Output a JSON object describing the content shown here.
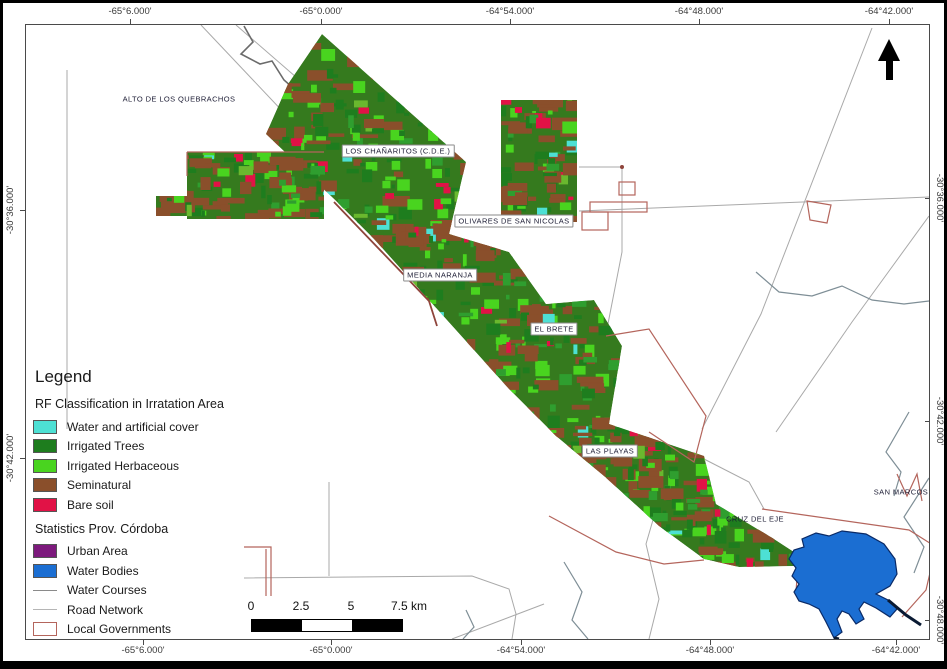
{
  "window": {
    "width": 947,
    "height": 669
  },
  "colors": {
    "frame": "#4a4a4a",
    "road": "#a9a9a9",
    "water_course": "#7e8e96",
    "dark_river": "#6b6b6b",
    "local_gov": "#b4655c",
    "local_gov_dark": "#8f453c",
    "water_body_fill": "#1b6ed2",
    "water_body_stroke": "#0a2a66",
    "raster_base": "#357a1e",
    "raster_palette": [
      {
        "color": "#8a4f2b",
        "w": 0.32
      },
      {
        "color": "#1e7d1e",
        "w": 0.26
      },
      {
        "color": "#49d41f",
        "w": 0.22
      },
      {
        "color": "#2f9e2f",
        "w": 0.1
      },
      {
        "color": "#6ab82e",
        "w": 0.04
      },
      {
        "color": "#e11246",
        "w": 0.04
      },
      {
        "color": "#4de0d4",
        "w": 0.02
      }
    ]
  },
  "map": {
    "axis": {
      "top": [
        {
          "label": "-65°6.000'",
          "x": 127
        },
        {
          "label": "-65°0.000'",
          "x": 318
        },
        {
          "label": "-64°54.000'",
          "x": 507
        },
        {
          "label": "-64°48.000'",
          "x": 696
        },
        {
          "label": "-64°42.000'",
          "x": 886
        }
      ],
      "bottom": [
        {
          "label": "-65°6.000'",
          "x": 140
        },
        {
          "label": "-65°0.000'",
          "x": 328
        },
        {
          "label": "-64°54.000'",
          "x": 518
        },
        {
          "label": "-64°48.000'",
          "x": 707
        },
        {
          "label": "-64°42.000'",
          "x": 893
        }
      ],
      "left": [
        {
          "label": "-30°36.000'",
          "y": 207
        },
        {
          "label": "-30°42.000'",
          "y": 455
        }
      ],
      "right": [
        {
          "label": "-30°36.000'",
          "y": 195
        },
        {
          "label": "-30°42.000'",
          "y": 418
        },
        {
          "label": "-30°48.000'",
          "y": 617
        }
      ]
    },
    "places": [
      {
        "name": "ALTO DE LOS QUEBRACHOS",
        "x": 176,
        "y": 96,
        "boxed": false
      },
      {
        "name": "LOS CHAÑARITOS (C.D.E.)",
        "x": 395,
        "y": 148,
        "boxed": true
      },
      {
        "name": "OLIVARES DE SAN NICOLAS",
        "x": 511,
        "y": 218,
        "boxed": true
      },
      {
        "name": "MEDIA NARANJA",
        "x": 437,
        "y": 272,
        "boxed": true
      },
      {
        "name": "EL BRETE",
        "x": 551,
        "y": 326,
        "boxed": true
      },
      {
        "name": "LAS PLAYAS",
        "x": 607,
        "y": 448,
        "boxed": true
      },
      {
        "name": "CRUZ DEL EJE",
        "x": 752,
        "y": 516,
        "boxed": false
      },
      {
        "name": "SAN MARCOS",
        "x": 898,
        "y": 489,
        "boxed": false
      }
    ],
    "scalebar": {
      "labels": [
        {
          "text": "0",
          "x": 248
        },
        {
          "text": "2.5",
          "x": 298
        },
        {
          "text": "5",
          "x": 348
        },
        {
          "text": "7.5 km",
          "x": 406
        }
      ],
      "bar": {
        "x": 248,
        "y": 616,
        "segment_width": 50,
        "height": 11,
        "segments": [
          "#000000",
          "#ffffff",
          "#000000"
        ]
      }
    },
    "north_arrow": "north-arrow"
  },
  "legend": {
    "title": "Legend",
    "sections": [
      {
        "heading": "RF Classification in Irratation Area",
        "items": [
          {
            "label": "Water and artificial cover",
            "swatch": "#4de0d4",
            "type": "fill"
          },
          {
            "label": "Irrigated Trees",
            "swatch": "#1e7d1e",
            "type": "fill"
          },
          {
            "label": "Irrigated Herbaceous",
            "swatch": "#49d41f",
            "type": "fill"
          },
          {
            "label": "Seminatural",
            "swatch": "#8a4f2b",
            "type": "fill"
          },
          {
            "label": "Bare soil",
            "swatch": "#e11246",
            "type": "fill"
          }
        ]
      },
      {
        "heading": "Statistics Prov. Córdoba",
        "items": [
          {
            "label": "Urban Area",
            "swatch": "#7d1a7d",
            "type": "fill"
          },
          {
            "label": "Water Bodies",
            "swatch": "#1b6ed2",
            "type": "fill"
          },
          {
            "label": "Water Courses",
            "swatch": "#8a8a8a",
            "type": "line"
          },
          {
            "label": "Road Network",
            "swatch": "#b5b5b5",
            "type": "line"
          },
          {
            "label": "Local Governments",
            "swatch": "#b4655c",
            "type": "outline"
          }
        ]
      }
    ]
  }
}
